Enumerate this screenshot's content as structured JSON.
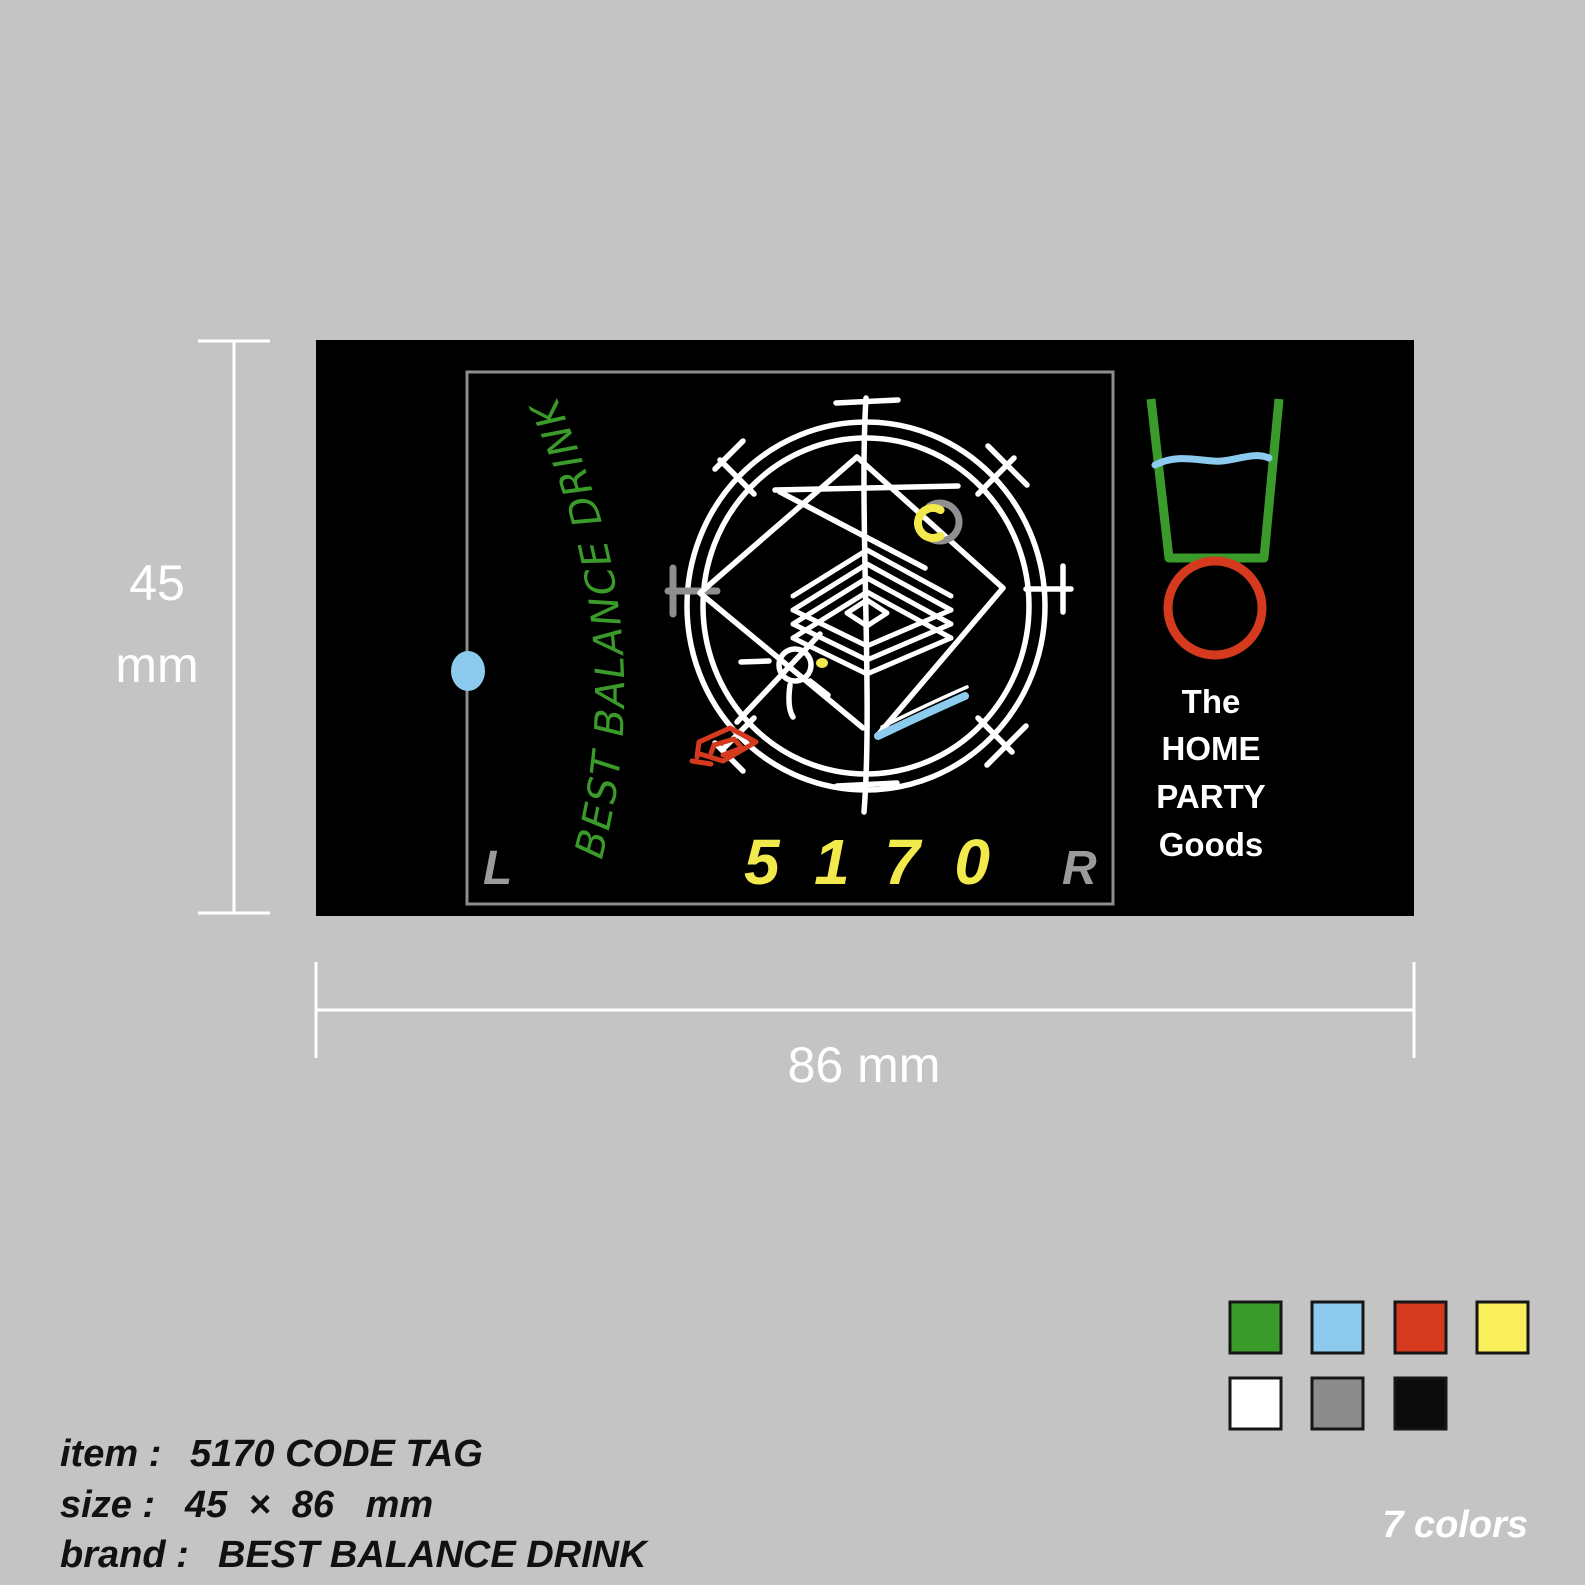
{
  "colors": {
    "background": "#c4c4c4",
    "tag_bg": "#000000",
    "green": "#3a9a2a",
    "light_blue": "#8dcbee",
    "red": "#d63a1e",
    "yellow": "#f2e94c",
    "white": "#ffffff",
    "gray": "#8e8e8e",
    "black": "#0b0b0b"
  },
  "tag": {
    "brand_curved_text": "BEST BALANCE DRINK",
    "code": "5 1 7 0",
    "left_marker": "L",
    "right_marker": "R",
    "logo_lines": [
      "The",
      "HOME",
      "PARTY",
      "Goods"
    ]
  },
  "dimensions": {
    "height_value": "45",
    "height_unit": "mm",
    "width_label": "86 mm"
  },
  "info": {
    "item_label": "item :",
    "item_value": "5170 CODE TAG",
    "size_label": "size :",
    "size_value": "45  ×  86   mm",
    "brand_label": "brand :",
    "brand_value": "BEST BALANCE DRINK"
  },
  "palette": {
    "count_label": "7 colors",
    "colors": [
      {
        "name": "green",
        "hex": "#3a9a2a"
      },
      {
        "name": "light-blue",
        "hex": "#8dcbee"
      },
      {
        "name": "red",
        "hex": "#d63a1e"
      },
      {
        "name": "yellow",
        "hex": "#f8ef5a"
      },
      {
        "name": "white",
        "hex": "#ffffff"
      },
      {
        "name": "gray",
        "hex": "#8c8c8c"
      },
      {
        "name": "black",
        "hex": "#0b0b0b"
      }
    ]
  }
}
